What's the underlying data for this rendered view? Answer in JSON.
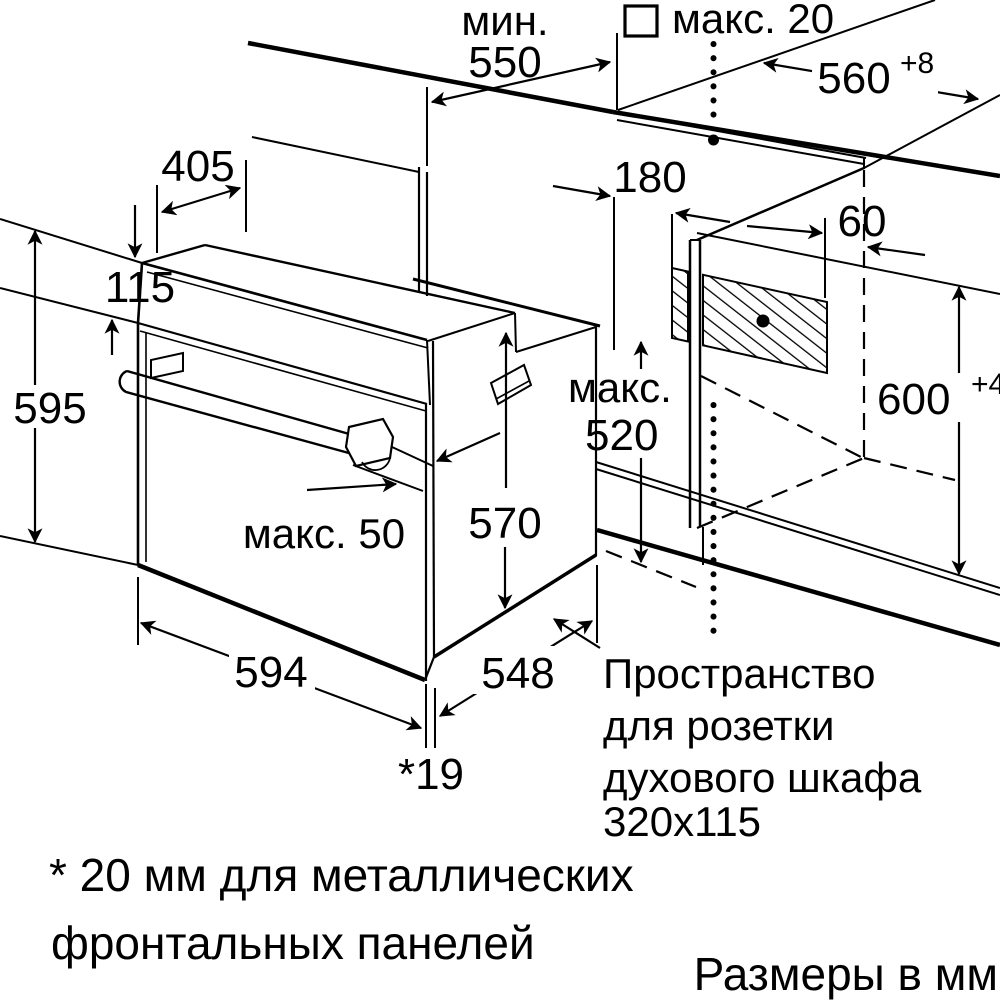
{
  "diagram": {
    "title_hint": "Oven installation drawing",
    "units_note": "Размеры в мм",
    "dims": {
      "min_prefix": "мин.",
      "min550": "550",
      "max20": "макс. 20",
      "w560": "560",
      "w560_tol": "+8",
      "d405": "405",
      "h115": "115",
      "h595": "595",
      "o180": "180",
      "o60": "60",
      "max520_prefix": "макс.",
      "max520": "520",
      "h570": "570",
      "max50": "макс. 50",
      "h600": "600",
      "h600_tol": "+4",
      "w594": "594",
      "d548": "548",
      "gap19": "*19"
    },
    "socket_note": {
      "line1": "Пространство",
      "line2": "для розетки",
      "line3": "духового шкафа",
      "line4": "320x115"
    },
    "footnote": {
      "line1": "* 20 мм для металлических",
      "line2": "фронтальных панелей"
    },
    "colors": {
      "ink": "#000000",
      "paper": "#ffffff"
    }
  }
}
